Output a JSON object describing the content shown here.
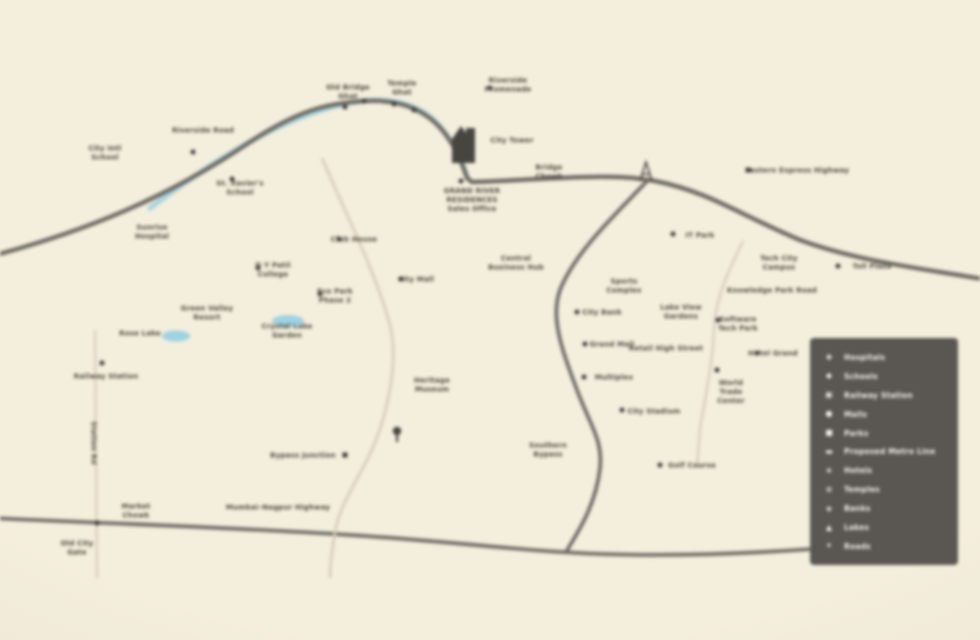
{
  "colors": {
    "bg_center": "#f4eedd",
    "bg_mid": "#ece5d1",
    "bg_edge": "#e2dbc6",
    "road_dark": "#6f6c66",
    "road_light": "#d3ccb8",
    "river": "#a6d4dd",
    "lake": "#9fd2e2",
    "label_text": "#4b463a",
    "marker": "#3f3d38",
    "icon_dark": "#474540",
    "legend_bg": "#5a5752",
    "legend_fg": "#f2f1ec"
  },
  "legend": {
    "items": [
      {
        "icon": "✚",
        "icon_name": "hospital-icon",
        "label": "Hospitals"
      },
      {
        "icon": "◆",
        "icon_name": "school-icon",
        "label": "Schools"
      },
      {
        "icon": "▣",
        "icon_name": "railway-icon",
        "label": "Railway Station"
      },
      {
        "icon": "●",
        "icon_name": "mall-icon",
        "label": "Malls"
      },
      {
        "icon": "■",
        "icon_name": "park-icon",
        "label": "Parks"
      },
      {
        "icon": "▬",
        "icon_name": "metro-line-icon",
        "label": "Proposed Metro Line"
      },
      {
        "icon": "★",
        "icon_name": "hotel-icon",
        "label": "Hotels"
      },
      {
        "icon": "⊕",
        "icon_name": "temple-icon",
        "label": "Temples"
      },
      {
        "icon": "◈",
        "icon_name": "bank-icon",
        "label": "Banks"
      },
      {
        "icon": "▲",
        "icon_name": "lake-icon",
        "label": "Lakes"
      },
      {
        "icon": "✦",
        "icon_name": "road-icon",
        "label": "Roads"
      }
    ]
  },
  "labels": [
    {
      "x": 105,
      "y": 153,
      "text": "City Intl\nSchool"
    },
    {
      "x": 203,
      "y": 131,
      "text": "Riverside Road"
    },
    {
      "x": 240,
      "y": 188,
      "text": "St. Xavier's\nSchool"
    },
    {
      "x": 152,
      "y": 232,
      "text": "Sunrise\nHospital"
    },
    {
      "x": 273,
      "y": 270,
      "text": "D Y Patil\nCollege"
    },
    {
      "x": 207,
      "y": 313,
      "text": "Green Valley\nResort"
    },
    {
      "x": 140,
      "y": 334,
      "text": "Rose Lake"
    },
    {
      "x": 287,
      "y": 331,
      "text": "Crystal Lake\nGarden"
    },
    {
      "x": 106,
      "y": 377,
      "text": "Railway Station"
    },
    {
      "x": 93,
      "y": 443,
      "text": "Station Rd",
      "rot": true
    },
    {
      "x": 136,
      "y": 511,
      "text": "Market\nChowk"
    },
    {
      "x": 77,
      "y": 548,
      "text": "Old City\nGate"
    },
    {
      "x": 303,
      "y": 456,
      "text": "Bypass Junction"
    },
    {
      "x": 278,
      "y": 508,
      "text": "Mumbai–Nagpur Highway"
    },
    {
      "x": 354,
      "y": 240,
      "text": "Club House"
    },
    {
      "x": 335,
      "y": 296,
      "text": "Eco Park\nPhase 2"
    },
    {
      "x": 416,
      "y": 280,
      "text": "City Mall"
    },
    {
      "x": 432,
      "y": 385,
      "text": "Heritage\nMuseum"
    },
    {
      "x": 348,
      "y": 92,
      "text": "Old Bridge\nGhat"
    },
    {
      "x": 402,
      "y": 88,
      "text": "Temple\nGhat"
    },
    {
      "x": 508,
      "y": 85,
      "text": "Riverside\nPromenade"
    },
    {
      "x": 512,
      "y": 141,
      "text": "City Tower"
    },
    {
      "x": 472,
      "y": 200,
      "text": "GRAND RIVER\nRESIDENCES\nSales Office"
    },
    {
      "x": 549,
      "y": 172,
      "text": "Bridge\nChowk"
    },
    {
      "x": 797,
      "y": 171,
      "text": "Eastern Express Highway"
    },
    {
      "x": 700,
      "y": 236,
      "text": "IT Park"
    },
    {
      "x": 516,
      "y": 263,
      "text": "Central\nBusiness Hub"
    },
    {
      "x": 624,
      "y": 286,
      "text": "Sports\nComplex"
    },
    {
      "x": 779,
      "y": 263,
      "text": "Tech City\nCampus"
    },
    {
      "x": 872,
      "y": 267,
      "text": "Toll Plaza"
    },
    {
      "x": 772,
      "y": 291,
      "text": "Knowledge Park Road"
    },
    {
      "x": 738,
      "y": 324,
      "text": "Software\nTech Park"
    },
    {
      "x": 602,
      "y": 313,
      "text": "City Bank"
    },
    {
      "x": 681,
      "y": 312,
      "text": "Lake View\nGardens"
    },
    {
      "x": 612,
      "y": 345,
      "text": "Grand Mall"
    },
    {
      "x": 666,
      "y": 349,
      "text": "Retail High Street"
    },
    {
      "x": 773,
      "y": 354,
      "text": "Hotel Grand"
    },
    {
      "x": 614,
      "y": 378,
      "text": "Multiplex"
    },
    {
      "x": 654,
      "y": 412,
      "text": "City Stadium"
    },
    {
      "x": 692,
      "y": 466,
      "text": "Golf Course"
    },
    {
      "x": 548,
      "y": 450,
      "text": "Southern\nBypass"
    },
    {
      "x": 731,
      "y": 392,
      "text": "World\nTrade\nCenter"
    }
  ],
  "markers": [
    {
      "x": 193,
      "y": 152,
      "type": "dot"
    },
    {
      "x": 232,
      "y": 179,
      "type": "dot"
    },
    {
      "x": 258,
      "y": 268,
      "type": "dot"
    },
    {
      "x": 102,
      "y": 363,
      "type": "dot"
    },
    {
      "x": 97,
      "y": 523,
      "type": "dot"
    },
    {
      "x": 345,
      "y": 455,
      "type": "square"
    },
    {
      "x": 339,
      "y": 239,
      "type": "dot"
    },
    {
      "x": 320,
      "y": 294,
      "type": "dot"
    },
    {
      "x": 401,
      "y": 279,
      "type": "dot"
    },
    {
      "x": 490,
      "y": 88,
      "type": "dot"
    },
    {
      "x": 461,
      "y": 181,
      "type": "dot"
    },
    {
      "x": 749,
      "y": 170,
      "type": "dot"
    },
    {
      "x": 673,
      "y": 234,
      "type": "dot"
    },
    {
      "x": 838,
      "y": 266,
      "type": "dot"
    },
    {
      "x": 718,
      "y": 320,
      "type": "dot"
    },
    {
      "x": 577,
      "y": 312,
      "type": "dot"
    },
    {
      "x": 585,
      "y": 344,
      "type": "dot"
    },
    {
      "x": 757,
      "y": 353,
      "type": "dot"
    },
    {
      "x": 584,
      "y": 377,
      "type": "dot"
    },
    {
      "x": 622,
      "y": 410,
      "type": "dot"
    },
    {
      "x": 660,
      "y": 465,
      "type": "dot"
    },
    {
      "x": 717,
      "y": 370,
      "type": "dot"
    },
    {
      "x": 345,
      "y": 107,
      "type": "dot"
    },
    {
      "x": 364,
      "y": 101,
      "type": "dot"
    },
    {
      "x": 394,
      "y": 104,
      "type": "dot"
    },
    {
      "x": 414,
      "y": 110,
      "type": "dot"
    }
  ]
}
